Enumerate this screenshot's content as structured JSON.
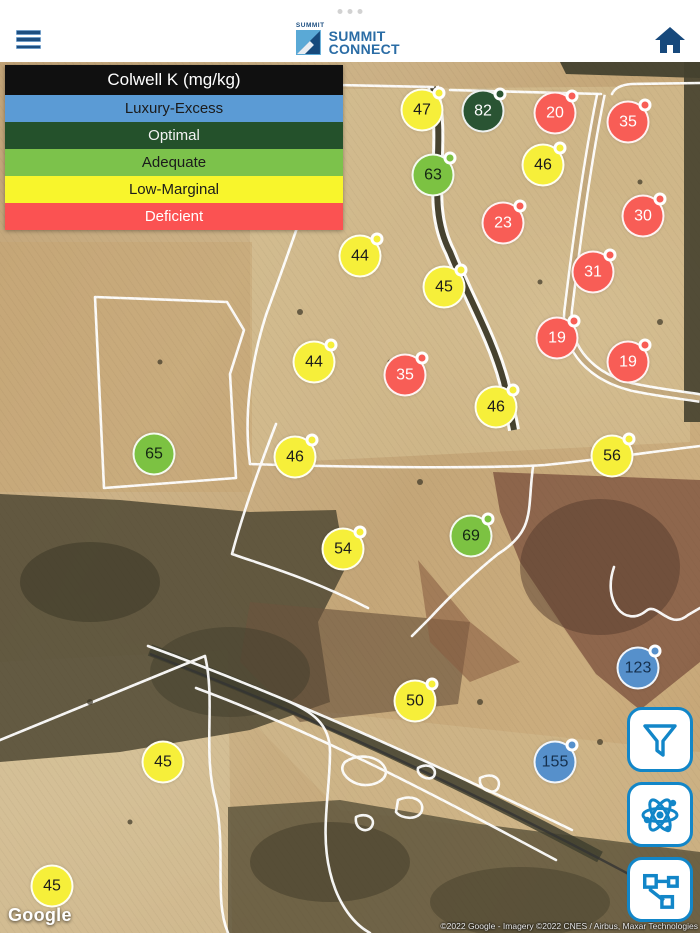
{
  "header": {
    "logo": {
      "brand_small": "SUMMIT",
      "line1": "SUMMIT",
      "line2": "CONNECT"
    },
    "icons": [
      "hamburger-menu-icon",
      "summit-logo-mark",
      "home-icon",
      "status-dots"
    ]
  },
  "legend": {
    "title": "Colwell K (mg/kg)",
    "rows": [
      {
        "label": "Luxury-Excess",
        "color": "#5b9bd5",
        "text_color": "#1b1b1b"
      },
      {
        "label": "Optimal",
        "color": "#24512b",
        "text_color": "#f2f2f2"
      },
      {
        "label": "Adequate",
        "color": "#7cc24b",
        "text_color": "#1b1b1b"
      },
      {
        "label": "Low-Marginal",
        "color": "#f8f52c",
        "text_color": "#1b1b1b"
      },
      {
        "label": "Deficient",
        "color": "#fb5252",
        "text_color": "#ffffff"
      }
    ]
  },
  "marker_styles": {
    "luxury-excess": {
      "fill": "#5690cb",
      "text": "#15304e"
    },
    "optimal": {
      "fill": "#2a5433",
      "text": "#ffffff"
    },
    "adequate": {
      "fill": "#7cc242",
      "text": "#142613"
    },
    "low-marginal": {
      "fill": "#f6ef3a",
      "text": "#1c1c1c"
    },
    "deficient": {
      "fill": "#f85d56",
      "text": "#ffffff"
    }
  },
  "markers": [
    {
      "value": "47",
      "category": "low-marginal",
      "x": 422,
      "y": 48,
      "badge": true
    },
    {
      "value": "82",
      "category": "optimal",
      "x": 483,
      "y": 49,
      "badge": true
    },
    {
      "value": "20",
      "category": "deficient",
      "x": 555,
      "y": 51,
      "badge": true
    },
    {
      "value": "35",
      "category": "deficient",
      "x": 628,
      "y": 60,
      "badge": true
    },
    {
      "value": "46",
      "category": "low-marginal",
      "x": 543,
      "y": 103,
      "badge": true
    },
    {
      "value": "63",
      "category": "adequate",
      "x": 433,
      "y": 113,
      "badge": true
    },
    {
      "value": "30",
      "category": "deficient",
      "x": 643,
      "y": 154,
      "badge": true
    },
    {
      "value": "23",
      "category": "deficient",
      "x": 503,
      "y": 161,
      "badge": true
    },
    {
      "value": "44",
      "category": "low-marginal",
      "x": 360,
      "y": 194,
      "badge": true
    },
    {
      "value": "31",
      "category": "deficient",
      "x": 593,
      "y": 210,
      "badge": true
    },
    {
      "value": "45",
      "category": "low-marginal",
      "x": 444,
      "y": 225,
      "badge": true
    },
    {
      "value": "19",
      "category": "deficient",
      "x": 557,
      "y": 276,
      "badge": true
    },
    {
      "value": "44",
      "category": "low-marginal",
      "x": 314,
      "y": 300,
      "badge": true
    },
    {
      "value": "19",
      "category": "deficient",
      "x": 628,
      "y": 300,
      "badge": true
    },
    {
      "value": "35",
      "category": "deficient",
      "x": 405,
      "y": 313,
      "badge": true
    },
    {
      "value": "46",
      "category": "low-marginal",
      "x": 496,
      "y": 345,
      "badge": true
    },
    {
      "value": "65",
      "category": "adequate",
      "x": 154,
      "y": 392,
      "badge": false
    },
    {
      "value": "56",
      "category": "low-marginal",
      "x": 612,
      "y": 394,
      "badge": true
    },
    {
      "value": "46",
      "category": "low-marginal",
      "x": 295,
      "y": 395,
      "badge": true
    },
    {
      "value": "69",
      "category": "adequate",
      "x": 471,
      "y": 474,
      "badge": true
    },
    {
      "value": "54",
      "category": "low-marginal",
      "x": 343,
      "y": 487,
      "badge": true
    },
    {
      "value": "123",
      "category": "luxury-excess",
      "x": 638,
      "y": 606,
      "badge": true
    },
    {
      "value": "50",
      "category": "low-marginal",
      "x": 415,
      "y": 639,
      "badge": true
    },
    {
      "value": "155",
      "category": "luxury-excess",
      "x": 555,
      "y": 700,
      "badge": true
    },
    {
      "value": "45",
      "category": "low-marginal",
      "x": 163,
      "y": 700,
      "badge": false
    },
    {
      "value": "45",
      "category": "low-marginal",
      "x": 52,
      "y": 824,
      "badge": false
    }
  ],
  "toolbar": {
    "accent": "#1286c8",
    "buttons": [
      {
        "name": "filter",
        "icon": "filter-funnel-icon"
      },
      {
        "name": "science",
        "icon": "atom-icon"
      },
      {
        "name": "network",
        "icon": "network-nodes-icon"
      }
    ]
  },
  "map": {
    "google_logo": "Google",
    "attribution": "©2022 Google - Imagery ©2022 CNES / Airbus, Maxar Technologies"
  }
}
